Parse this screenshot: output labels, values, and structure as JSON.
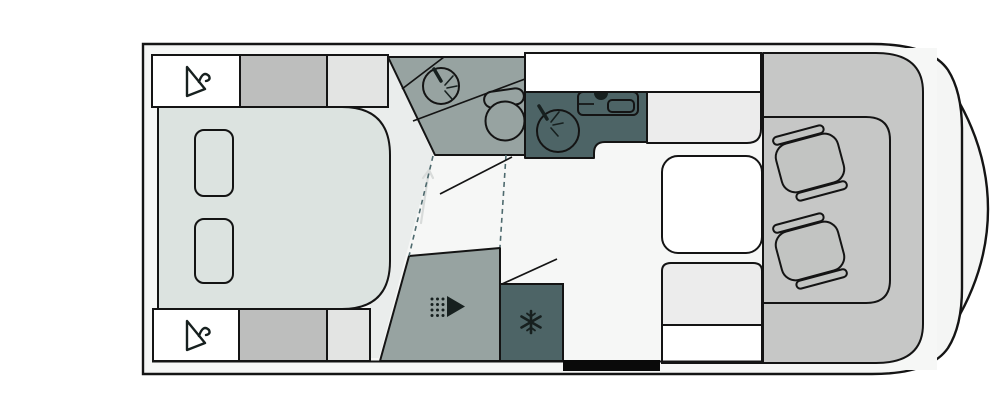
{
  "diagram": {
    "kind": "motorhome-floorplan",
    "orientation": "cab-right",
    "text_labels": []
  },
  "colors": {
    "outline": "#141414",
    "icon_dark": "#17201f",
    "shell": "#f4f5f4",
    "floor": "#f6f7f6",
    "wet_room": "#97a3a1",
    "kitchen_unit": "#4d6466",
    "cab_floor": "#c6c7c6",
    "seat": "#c2c4c2",
    "cabinet_gray": "#bdbebd",
    "cabinet_light": "#e3e4e3",
    "bench_light": "#ececec",
    "bed": "#dce3e0",
    "white": "#ffffff",
    "entry_door_marker": "#0a0a0a",
    "door_track_dashed": "#4e6a6e",
    "faint_arrow": "#d8dbda",
    "floor_shading": "#eaedec"
  },
  "icons": {
    "wardrobe_top": "hanger-icon",
    "wardrobe_bottom": "hanger-icon",
    "shower": "shower-head-icon",
    "fridge": "snowflake-icon",
    "bathroom_fixtures": [
      "washbasin-with-tap",
      "toilet"
    ],
    "kitchen_fixtures": [
      "sink-with-tap",
      "hob"
    ],
    "cab_fixtures": [
      "swivel-seat",
      "swivel-seat"
    ],
    "hallway_markers": [
      "door-swing-line",
      "door-swing-line",
      "sliding-door-track-dashed",
      "sliding-door-track-dashed",
      "walkway-arrow"
    ]
  },
  "fixtures": {
    "bed": {
      "pillows": 2
    },
    "dinette": {
      "table": 1,
      "benches": 2
    },
    "entry": {
      "door_marker": "bottom-wall"
    }
  }
}
